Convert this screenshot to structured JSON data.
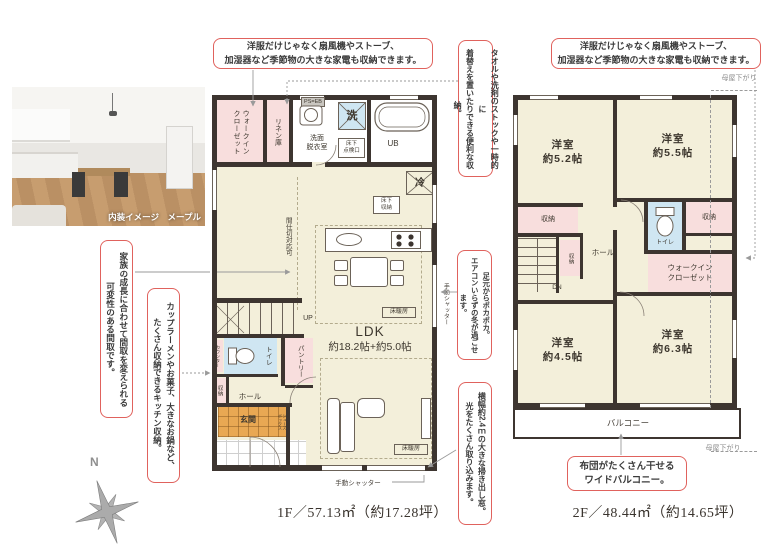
{
  "colors": {
    "annotation_border": "#e0625d",
    "wall": "#3d3530",
    "room_cream": "#f3efda",
    "closet_pink": "#f8dedd",
    "wet_blue": "#cfe6f2",
    "entrance_orange": "#e9a853",
    "leader_gray": "#9a9a9a"
  },
  "photo": {
    "caption": "内装イメージ　メープル"
  },
  "compass": {
    "north": "N"
  },
  "notes": {
    "closet1f": "洋服だけじゃなく扇風機やストーブ、\n加湿器など季節物の大きな家電も収納できます。",
    "closet2f": "洋服だけじゃなく扇風機やストーブ、\n加湿器など季節物の大きな家電も収納できます。",
    "linen": "タオルや洗剤のストックや一時的に\n着替えを置いたりできる便利な収納。",
    "heating": "足元からポカポカ。\nエアコンいらずの冬が過ごせます。",
    "window": "横幅約2.4ｍの大きな掃き出し窓。\n光をたくさん取り込みます。",
    "layout": "家族の成長に合わせて間取を変えられる\n可変性のある間取です。",
    "kitchen": "カップラーメンやお菓子、大きなお鍋など、\nたくさん収納できるキッチン収納。",
    "balcony": "布団がたくさん干せる\nワイドバルコニー。"
  },
  "f1": {
    "caption": "1F／57.13㎡（約17.28坪）",
    "wic": "ウォークイン\nクローゼット",
    "linen": "リネン庫",
    "wash": "洗面\n脱衣室",
    "laundry": "洗",
    "ps": "PS=EB",
    "ub": "UB",
    "hatch": "床下\n点検口",
    "fridge": "冷",
    "underfloor": "床下\n収納",
    "partition": "間仕切対応可",
    "ldk": "LDK",
    "ldk_size": "約18.2帖+約5.0帖",
    "yukadan": "床暖房",
    "up": "UP",
    "pantry": "パントリー",
    "counter": "カウンター",
    "toilet": "トイレ",
    "storage": "収納",
    "hall": "ホール",
    "entrance": "玄関",
    "shoes": "シューズ\nボックス",
    "shutter": "手動シャッター"
  },
  "f2": {
    "caption": "2F／48.44㎡（約14.65坪）",
    "room52": "洋室\n約5.2帖",
    "room55": "洋室\n約5.5帖",
    "room45": "洋室\n約4.5帖",
    "room63": "洋室\n約6.3帖",
    "storage": "収納",
    "toilet": "トイレ",
    "hall": "ホール",
    "dn": "DN",
    "wic": "ウォークイン\nクローゼット",
    "balcony": "バルコニー",
    "moya": "母屋下がり"
  }
}
